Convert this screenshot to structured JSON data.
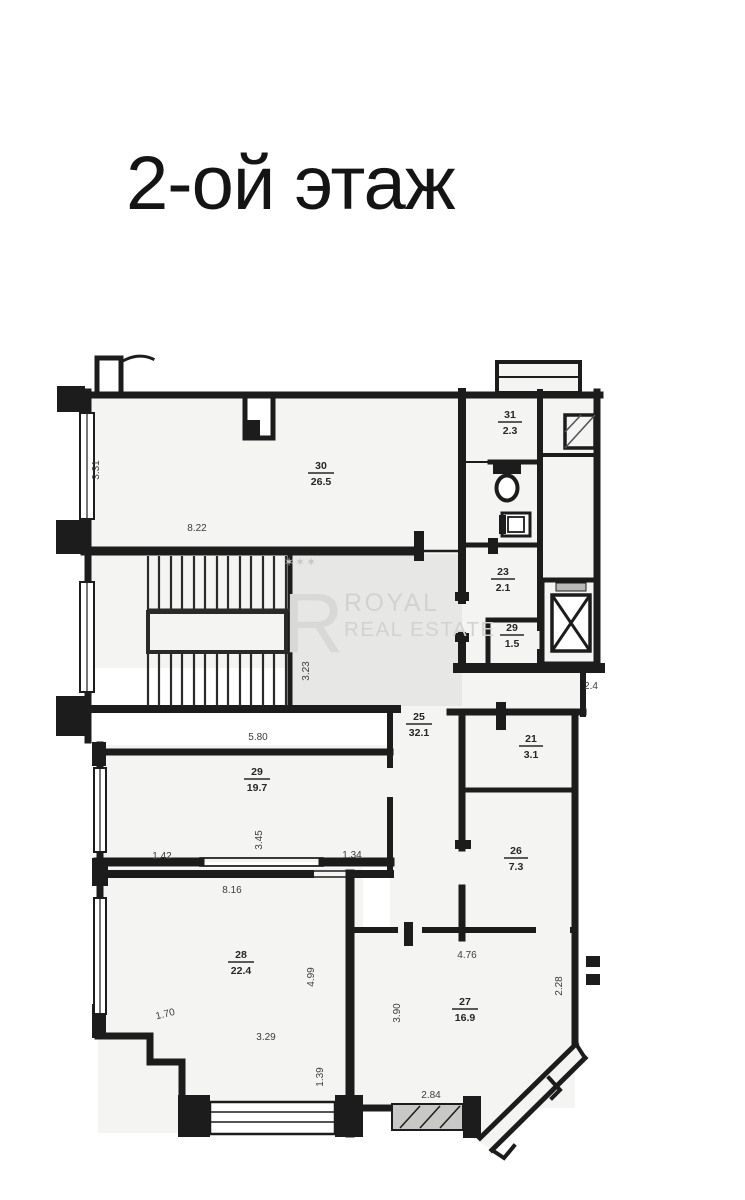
{
  "page": {
    "title": "2-ой этаж"
  },
  "watermark": {
    "stars": "✶✶✶",
    "monogram": "R",
    "brand_line1": "ROYAL",
    "brand_line2": "REAL ESTATE"
  },
  "floor_plan": {
    "rooms": {
      "r30": {
        "number": "30",
        "area": "26.5"
      },
      "r31": {
        "number": "31",
        "area": "2.3"
      },
      "r23": {
        "number": "23",
        "area": "2.1"
      },
      "r29_small": {
        "number": "29",
        "area": "1.5"
      },
      "r25": {
        "number": "25",
        "area": "32.1"
      },
      "r21": {
        "number": "21",
        "area": "3.1"
      },
      "r29": {
        "number": "29",
        "area": "19.7"
      },
      "r26": {
        "number": "26",
        "area": "7.3"
      },
      "r28": {
        "number": "28",
        "area": "22.4"
      },
      "r27": {
        "number": "27",
        "area": "16.9"
      }
    },
    "dimensions": {
      "r30_height": "3.31",
      "r30_width": "8.22",
      "stair_hall_height": "3.23",
      "hall_width": "2.4",
      "r29_width": "5.80",
      "r29_height": "3.45",
      "r29_left": "1.42",
      "r29_right": "1.34",
      "r28_width": "8.16",
      "r28_height": "4.99",
      "r28_left": "1.70",
      "r28_inner": "3.29",
      "r28_bottom": "1.39",
      "r27_left": "3.90",
      "r27_width": "4.76",
      "r27_right": "2.28",
      "r27_bottom": "2.84"
    }
  },
  "colors": {
    "wall": "#1c1c1c",
    "floor_fill": "#f4f4f2",
    "watermark_gray": "#d2d2d0",
    "title_color": "#141414"
  }
}
